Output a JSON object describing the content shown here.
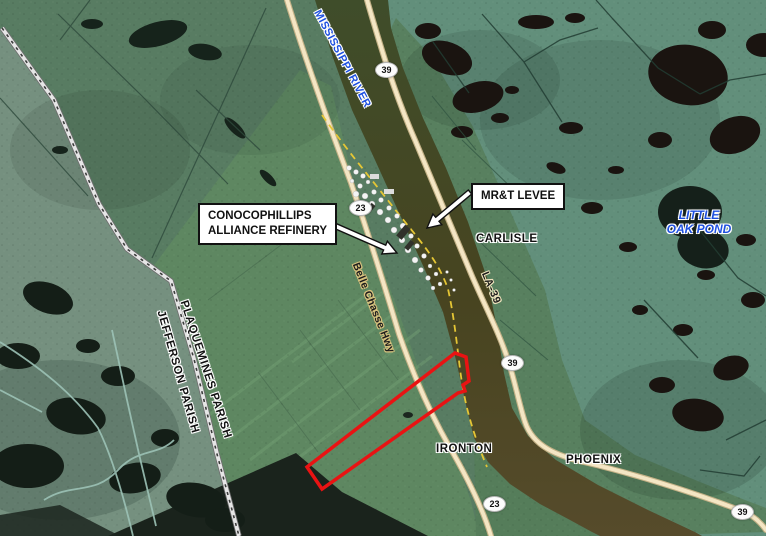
{
  "map": {
    "water_labels": {
      "mississippi_river": "MISSISSIPPI RIVER",
      "little_oak_pond": {
        "line1": "LITTLE",
        "line2": "OAK POND"
      }
    },
    "place_labels": {
      "carlisle": "CARLISLE",
      "ironton": "IRONTON",
      "phoenix": "PHOENIX"
    },
    "boundary_labels": {
      "plaquemines": "PLAQUEMINES PARISH",
      "jefferson": "JEFFERSON PARISH"
    },
    "road_labels": {
      "belle_chasse_hwy": "Belle Chasse Hwy",
      "la_39": "LA-39"
    },
    "callouts": {
      "refinery": {
        "line1": "CONOCOPHILLIPS",
        "line2": "ALLIANCE REFINERY"
      },
      "levee": "MR&T LEVEE"
    },
    "route_shields": {
      "north_39": "39",
      "refinery_23": "23",
      "mid_39": "39",
      "south_23": "23",
      "southeast_39": "39"
    },
    "colors": {
      "water_label_blue": "#1d50e0",
      "parcel_outline_red": "#e91313",
      "road_fill": "#f4e6c4",
      "levee_dash_yellow": "#e5c635",
      "river_olive": "#47491f"
    }
  }
}
